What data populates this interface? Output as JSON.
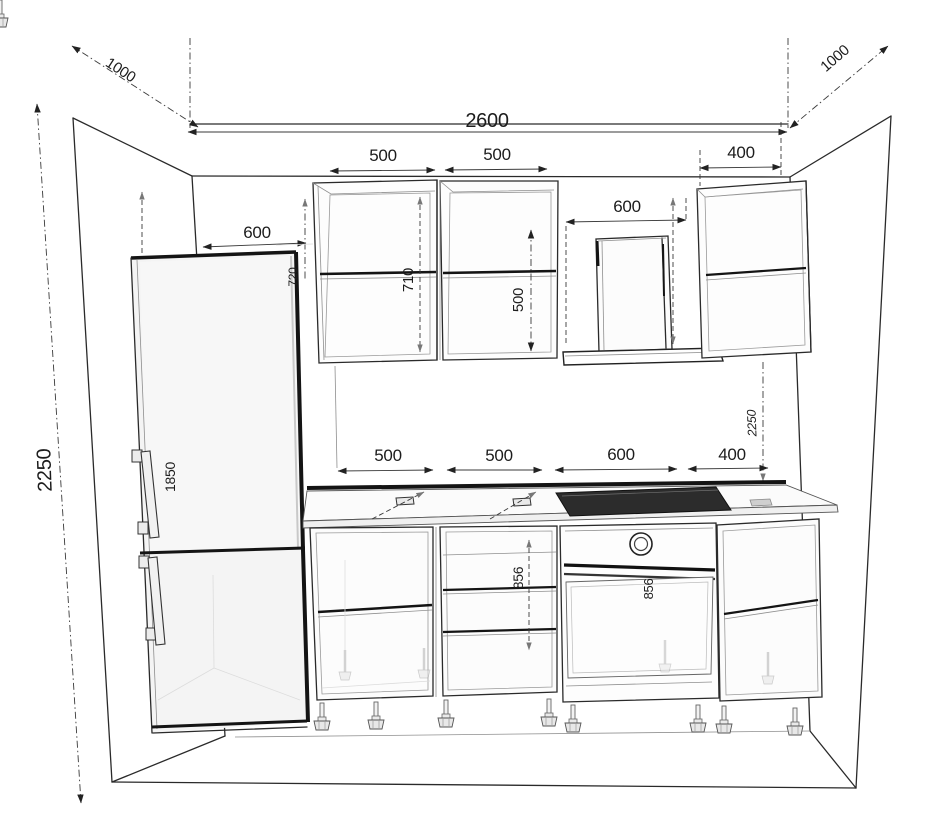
{
  "drawing": {
    "kind": "kitchen-elevation-technical-drawing",
    "dimensions": {
      "room_width": "2600",
      "room_height_left": "2250",
      "depth_left": "1000",
      "depth_right": "1000",
      "wall_cab_1_width": "500",
      "wall_cab_2_width": "500",
      "wall_cab_right_width": "400",
      "hood_width": "600",
      "fridge_width": "600",
      "fridge_height_faint": "1850",
      "fridge_top_clearance_faint": "720",
      "wall_cab_1_inner_height": "710",
      "wall_cab_2_inner_height": "500",
      "right_total_height": "2250",
      "base_1_width": "500",
      "base_2_width": "500",
      "base_3_width": "600",
      "base_4_width": "400",
      "base_1_inner_height": "856",
      "base_2_inner_height": "856",
      "oven_inner_height": "856"
    }
  }
}
